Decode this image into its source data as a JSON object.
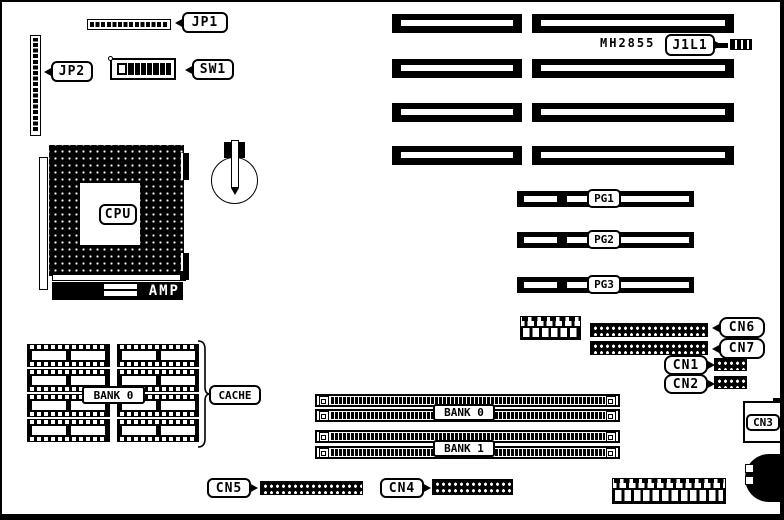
{
  "title": "Motherboard layout diagram",
  "labels": {
    "jp1": "JP1",
    "jp2": "JP2",
    "sw1": "SW1",
    "cpu": "CPU",
    "amp": "AMP",
    "chip": "MH2855",
    "j1l1": "J1L1",
    "pg1": "PG1",
    "pg2": "PG2",
    "pg3": "PG3",
    "cache_bank": "BANK 0",
    "cache": "CACHE",
    "bank0": "BANK 0",
    "bank1": "BANK 1",
    "cn1": "CN1",
    "cn2": "CN2",
    "cn3": "CN3",
    "cn4": "CN4",
    "cn5": "CN5",
    "cn6": "CN6",
    "cn7": "CN7"
  },
  "colors": {
    "ink": "#000000",
    "paper": "#ffffff"
  }
}
